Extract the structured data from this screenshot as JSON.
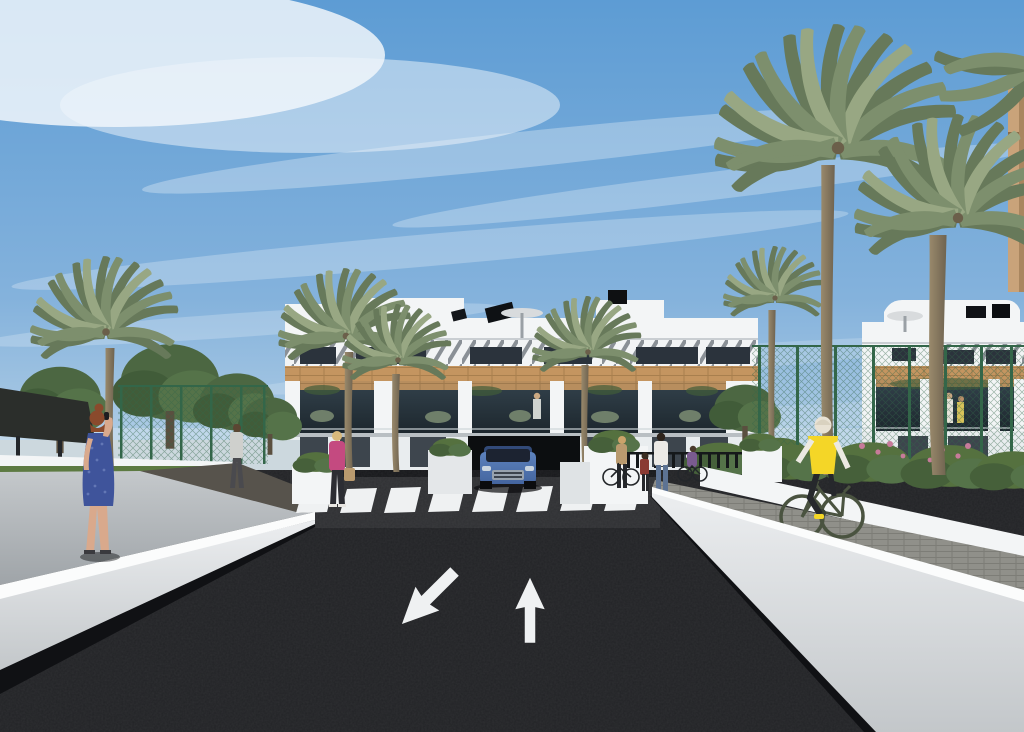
{
  "meta": {
    "title": "Architectural rendering – residential development street view",
    "type": "3d-visualization",
    "width_px": 1024,
    "height_px": 732
  },
  "palette": {
    "skyTop": "#5d9cd4",
    "skyHorizon": "#b9d3e7",
    "cloud": "#ffffff",
    "buildingWhite": "#f3f5f6",
    "louverStripe": "#8a9096",
    "windowDark": "#2b333c",
    "woodBand": "#c49560",
    "woodDark": "#a87f4e",
    "balconyGlass": "#1d272e",
    "palmFrond": "#7d8f6d",
    "palmFrondDark": "#67795a",
    "palmTrunk": "#6f6350",
    "treeGreen": "#4c6742",
    "fenceGreen": "#336649",
    "bushGreen": "#55713f",
    "flowerPink": "#c77b9a",
    "rampGray": "#9fa4a8",
    "pathBrick": "#90908a",
    "asphalt": "#222326",
    "asphaltLight": "#2f3033",
    "roadMark": "#eff1f2",
    "shadowDark": "#101114",
    "carBlue": "#44659f",
    "skinTone": "#d9a98c",
    "dressBlue": "#3f549b",
    "hairRed": "#8a4a2c",
    "topPink": "#c44a80",
    "vestYellow": "#f4d627",
    "bikeGreen": "#4a5340"
  },
  "scene": {
    "sky": {
      "label": "Blue sky with streaky cirrus clouds"
    },
    "buildings": {
      "center_block": {
        "label": "White three-storey apartment building with louvred top floor, wooden pergola balconies, rooftop solar panels, parasol and chimney"
      },
      "right_block": {
        "label": "White apartment building with curved roof volume and wooden pergola balconies"
      },
      "far_right_edge": {
        "label": "Tan building edge at the far right"
      }
    },
    "site": {
      "road": {
        "label": "Dark asphalt entrance road"
      },
      "crosswalk": {
        "label": "White zebra pedestrian crossing",
        "stripe_count": 8
      },
      "lane_arrows": [
        {
          "label": "Lane arrow pointing toward viewer (down-left)"
        },
        {
          "label": "Lane arrow pointing away (up)"
        }
      ],
      "left_wall": {
        "label": "White boundary wall along the left side"
      },
      "right_wall": {
        "label": "White boundary wall along the right side"
      },
      "right_path": {
        "label": "Paved pedestrian and cycle path behind the right wall"
      },
      "left_ramp": {
        "label": "Grey pedestrian ramp behind the left wall"
      },
      "garage": {
        "label": "Underground garage entrance below the building"
      },
      "green_fence": {
        "label": "Green mesh perimeter fence"
      },
      "planters": {
        "label": "White planter boxes with shrubs"
      },
      "canopy": {
        "label": "Dark shade canopy at far left"
      },
      "railing": {
        "label": "Dark slatted railing near the crossing"
      }
    },
    "vegetation": {
      "palm_trees": {
        "label": "Palm trees",
        "count": 7
      },
      "trees": {
        "label": "Leafy green trees",
        "count": 5
      },
      "bushes": {
        "label": "Shrubs and pink flowering bushes"
      }
    },
    "vehicle": {
      "car": {
        "label": "Blue SUV exiting the garage driveway"
      }
    },
    "people": [
      {
        "id": "woman-phone",
        "label": "Woman in blue dress with red hair on the phone, left foreground"
      },
      {
        "id": "man-walking",
        "label": "Man walking away on the left path"
      },
      {
        "id": "woman-pink",
        "label": "Blonde woman in pink top carrying a handbag"
      },
      {
        "id": "woman-bicycle",
        "label": "Woman standing with a bicycle near the crossing"
      },
      {
        "id": "child",
        "label": "Child standing near the crossing"
      },
      {
        "id": "adult-white-top",
        "label": "Adult in white top and jeans near the crossing"
      },
      {
        "id": "cyclist-purple",
        "label": "Cyclist in purple shirt behind the group"
      },
      {
        "id": "cyclist-yellow",
        "label": "Cyclist in yellow vest riding on the right path"
      },
      {
        "id": "balcony-residents",
        "label": "Residents on the right building balcony"
      },
      {
        "id": "balcony-resident-center",
        "label": "Resident on the center building balcony"
      }
    ]
  }
}
